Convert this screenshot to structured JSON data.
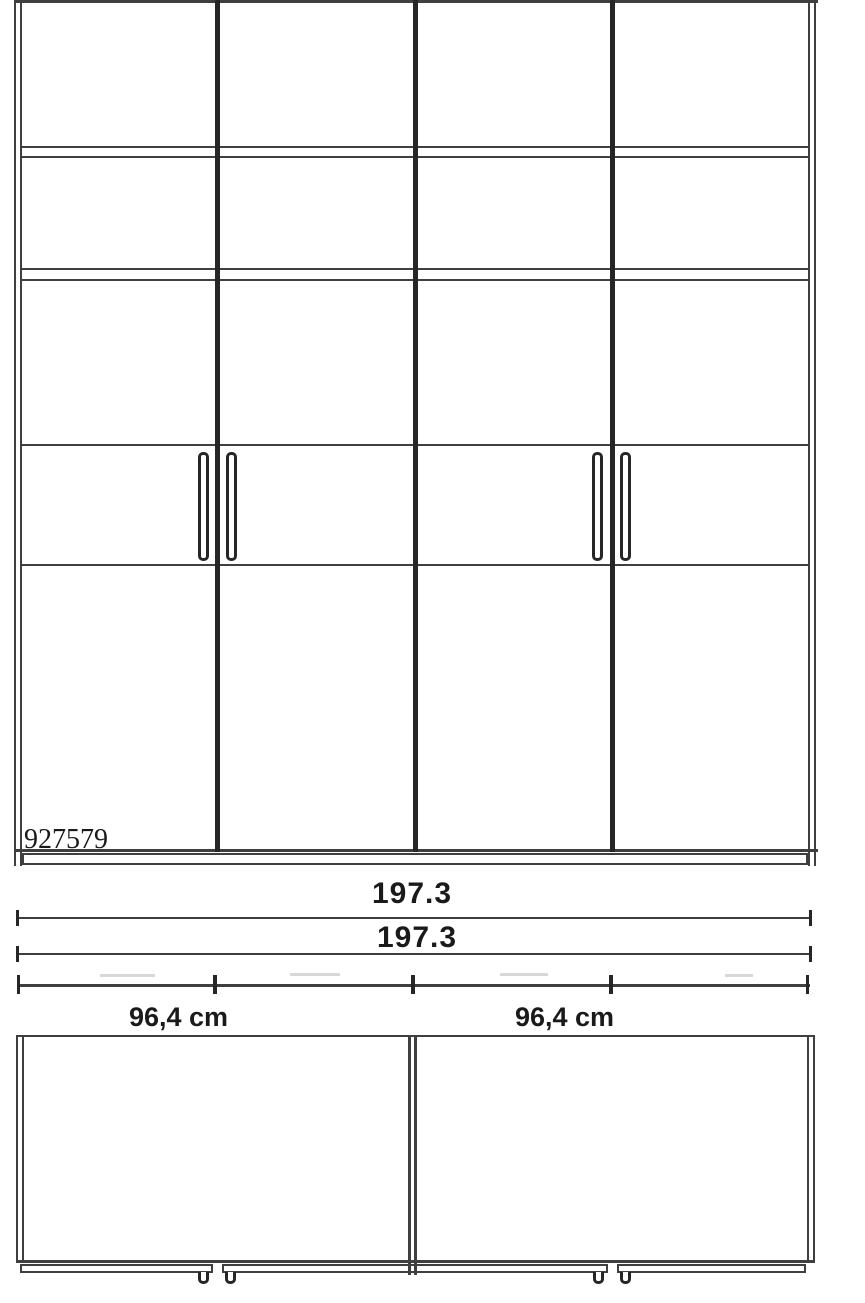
{
  "front_view": {
    "product_code": "927579"
  },
  "dimension_labels": {
    "overall_width_top": "197.3",
    "overall_width_bottom": "197.3",
    "left_door_pair_width": "96,4 cm",
    "right_door_pair_width": "96,4 cm"
  },
  "colors": {
    "bg": "#ffffff",
    "line": "#3f3f3f",
    "heavy": "#262626",
    "text": "#1a1a1a",
    "faint": "#d8d8d8"
  }
}
